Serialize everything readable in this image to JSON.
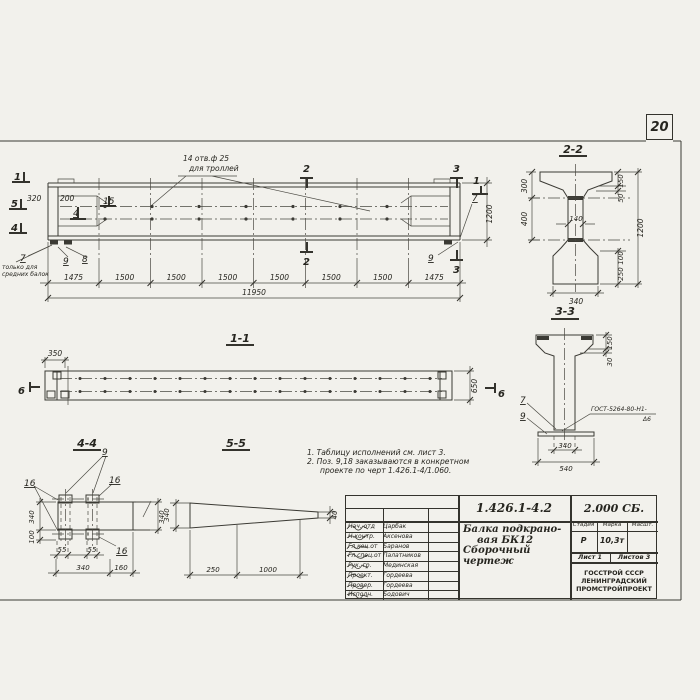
{
  "page": {
    "number": "20"
  },
  "main_view": {
    "hole_note_line1": "14 отв.ф 25",
    "hole_note_line2": "для троллей",
    "marker_1": "1",
    "marker_5": "5",
    "marker_4": "4",
    "marker_2": "2",
    "marker_3": "3",
    "dim_320": "320",
    "dim_200": "200",
    "pos_15": "15",
    "pos_4": "4",
    "pos_7": "7",
    "pos_8": "8",
    "pos_9": "9",
    "note_7_line1": "только для",
    "note_7_line2": "средних балок",
    "dims_bottom": [
      "1475",
      "1500",
      "1500",
      "1500",
      "1500",
      "1500",
      "1500",
      "1475"
    ],
    "dim_total": "11950",
    "dim_1200": "1200"
  },
  "section_1_1": {
    "title": "1-1",
    "dim_350": "350",
    "dim_650": "650",
    "marker_6": "6"
  },
  "section_2_2": {
    "title": "2-2",
    "dim_300": "300",
    "dim_400": "400",
    "dim_140": "140",
    "dim_150": "150",
    "dim_50": "50",
    "dim_1200": "1200",
    "dim_100": "100",
    "dim_250": "250",
    "dim_340": "340"
  },
  "section_3_3": {
    "title": "3-3",
    "pos_7": "7",
    "pos_9": "9",
    "weld_note": "ГОСТ-5264-80-Н1-",
    "weld_size": "Δ6",
    "dim_150": "150",
    "dim_30": "30",
    "dim_340": "340",
    "dim_540": "540"
  },
  "section_4_4": {
    "title": "4-4",
    "pos_9": "9",
    "pos_16": "16",
    "dim_340_left": "340",
    "dim_100": "100",
    "dim_340_right": "340",
    "dim_55a": "55",
    "dim_55b": "55",
    "dim_340_bottom": "340",
    "dim_160": "160"
  },
  "section_5_5": {
    "title": "5-5",
    "dim_340": "340",
    "dim_40": "40",
    "dim_250": "250",
    "dim_1000": "1000"
  },
  "notes": {
    "line1": "1. Таблицу исполнений см. лист 3.",
    "line2": "2. Поз. 9,18 заказываются в конкретном",
    "line3": "проекте по черт 1.426.1-4/1.060."
  },
  "title_block": {
    "doc_number": "1.426.1-4.2",
    "doc_code": "2.000 СБ.",
    "title_line1": "Балка подкрано-",
    "title_line2": "вая БК12",
    "title_line3": "Сборочный чертеж",
    "col_stage": "Стадия",
    "col_mark": "Марка",
    "col_scale": "Масшт.",
    "stage_value": "Р",
    "mass_value": "10,3т",
    "sheet": "Лист 1",
    "sheets": "Листов 3",
    "org_line1": "ГОССТРОЙ СССР",
    "org_line2": "ЛЕНИНГРАДСКИЙ",
    "org_line3": "ПРОМСТРОЙПРОЕКТ",
    "rows": [
      {
        "role": "Нач. отд",
        "name": "Царбак"
      },
      {
        "role": "Н.контр.",
        "name": "Аксенова"
      },
      {
        "role": "Гл.кон.от",
        "name": "Баранов"
      },
      {
        "role": "Гл.спец.от",
        "name": "Палатников"
      },
      {
        "role": "Рук. гр.",
        "name": "Мединская"
      },
      {
        "role": "Проект.",
        "name": "Гордеева"
      },
      {
        "role": "Провер.",
        "name": "Гордеева"
      },
      {
        "role": "Исполн.",
        "name": "Бодович"
      }
    ]
  }
}
